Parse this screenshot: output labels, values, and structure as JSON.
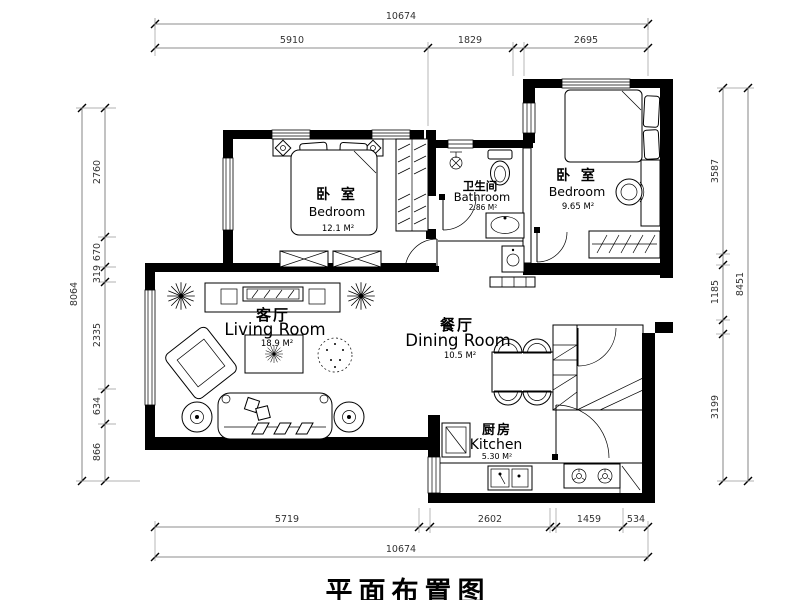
{
  "title": "平面布置图",
  "colors": {
    "ink": "#000000",
    "background": "#ffffff",
    "dim_text": "#333333"
  },
  "rooms": {
    "bedroom1": {
      "name_cn": "卧 室",
      "name_en": "Bedroom",
      "area": "12.1 M²"
    },
    "bathroom": {
      "name_cn": "卫生间",
      "name_en": "Bathroom",
      "area": "2.86 M²"
    },
    "bedroom2": {
      "name_cn": "卧 室",
      "name_en": "Bedroom",
      "area": "9.65 M²"
    },
    "living": {
      "name_cn": "客厅",
      "name_en": "Living Room",
      "area": "18.9 M²"
    },
    "dining": {
      "name_cn": "餐厅",
      "name_en": "Dining Room",
      "area": "10.5 M²"
    },
    "kitchen": {
      "name_cn": "厨房",
      "name_en": "Kitchen",
      "area": "5.30 M²"
    }
  },
  "dimensions": {
    "top": {
      "total": "10674",
      "segments": [
        "5910",
        "1829",
        "2695"
      ]
    },
    "bottom": {
      "total": "10674",
      "segments": [
        "5719",
        "2602",
        "1459",
        "534"
      ]
    },
    "left": {
      "total": "8064",
      "segments": [
        "2760",
        "670",
        "319",
        "2335",
        "634",
        "866"
      ]
    },
    "right": {
      "total": "8451",
      "segments": [
        "3587",
        "1185",
        "3199"
      ]
    }
  }
}
